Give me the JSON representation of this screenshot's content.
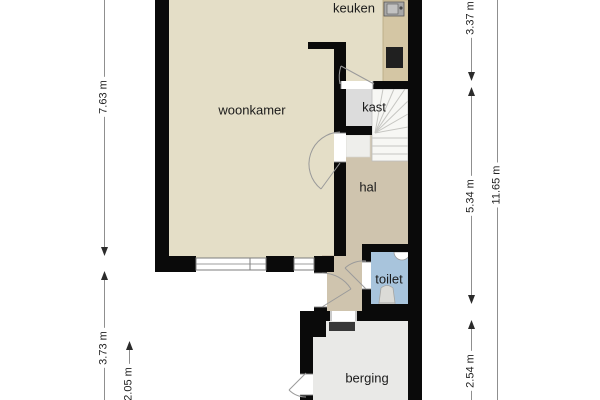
{
  "floorplan": {
    "rooms": {
      "keuken": "keuken",
      "woonkamer": "woonkamer",
      "kast": "kast",
      "hal": "hal",
      "toilet": "toilet",
      "berging": "berging"
    },
    "dimensions": {
      "left_living_height": "7.63 m",
      "left_lower_height": "3.73 m",
      "left_entry_height": "2.05 m",
      "right_kitchen_height": "3.37 m",
      "right_hall_height": "5.34 m",
      "right_storage_height": "2.54 m",
      "right_total_height": "11.65 m"
    },
    "colors": {
      "wall": "#0a0a0a",
      "living_floor": "#e4dec7",
      "hall_floor": "#cfc4ae",
      "closet_floor": "#dcdcdc",
      "stairs_floor": "#f7f7f4",
      "toilet_floor": "#a8c4dc",
      "storage_floor": "#e9e9e7",
      "counter": "#d4c6a4",
      "background": "#ffffff"
    }
  }
}
